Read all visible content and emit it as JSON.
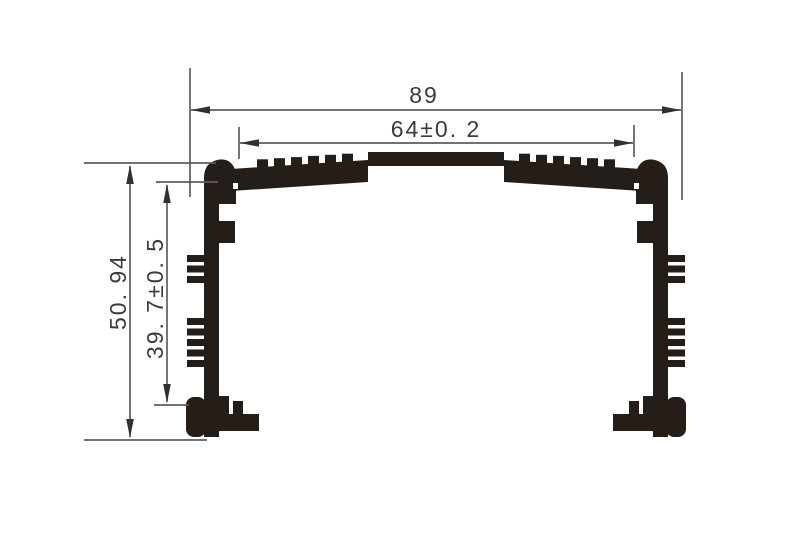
{
  "drawing": {
    "colors": {
      "background": "#ffffff",
      "profile": "#241d18",
      "dimension_line": "#5d5d5f",
      "arrow": "#323032",
      "text": "#3b3b3d"
    },
    "dimensions": {
      "overall_width": "89",
      "slot_width": "64±0. 2",
      "overall_height": "50. 94",
      "inner_height": "39. 7±0. 5"
    }
  }
}
